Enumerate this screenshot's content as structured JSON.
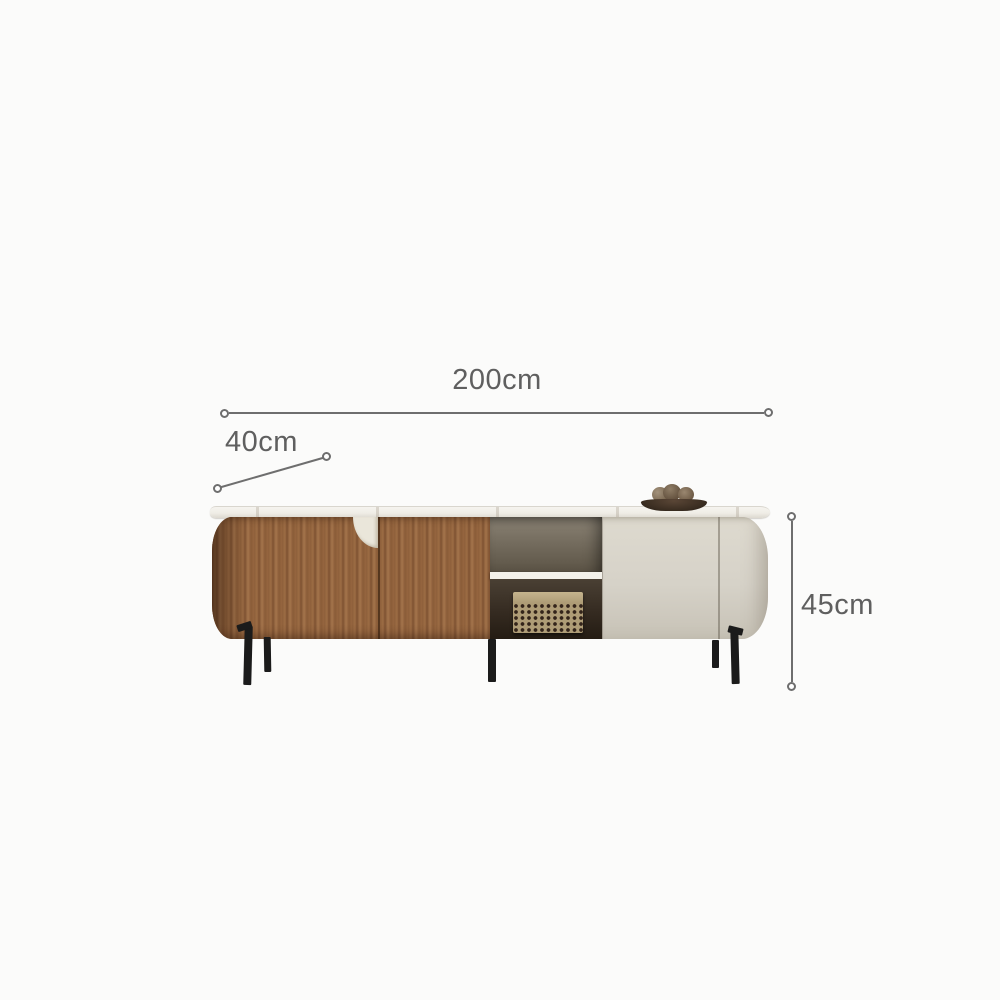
{
  "annotations": {
    "width": {
      "label": "200cm"
    },
    "depth": {
      "label": "40cm"
    },
    "height": {
      "label": "45cm"
    }
  },
  "product": {
    "name": "modern tv stand cabinet",
    "features": [
      "walnut wood double doors",
      "open shelf with woven basket",
      "cream lacquer door",
      "stone top",
      "black metal legs",
      "decor dish with pinecones"
    ]
  },
  "colors": {
    "background": "#fbfbfa",
    "dimension_line": "#6e6e6e",
    "dimension_text": "#5f5f5f",
    "top_slab": "#efede6",
    "wood": "#96663f",
    "cream_door": "#d6d2c8",
    "interior_upper": "#756d5f",
    "interior_lower": "#352b21",
    "shelf": "#f3f1ea",
    "basket": "#ae9c76",
    "handle": "#eae6da",
    "leg": "#1b1b1b",
    "bowl": "#3a2d21"
  }
}
